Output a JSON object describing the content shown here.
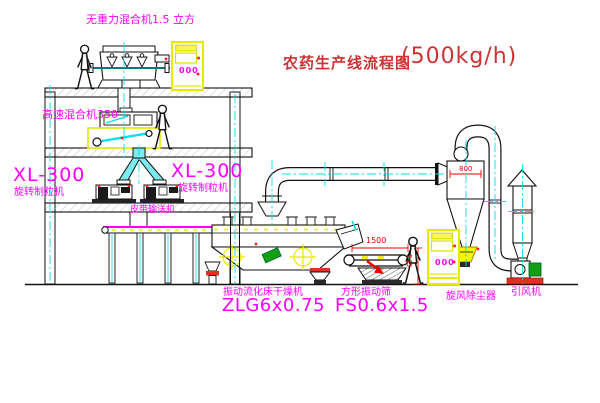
{
  "title": {
    "text": "农药生产线流程图",
    "capacity": "(500kg/h)"
  },
  "labels": {
    "gravity_mixer": "无重力混合机1.5 立方",
    "speed_mixer": "高速混合机350",
    "granulator1_model": "XL-300",
    "granulator1_name": "旋转制粒机",
    "granulator2_model": "XL-300",
    "granulator2_name": "旋转制粒机",
    "belt_conveyor": "皮带输送机",
    "dryer_name": "振动流化床干燥机",
    "dryer_model": "ZLG6x0.75",
    "screen_name": "方形振动筛",
    "screen_model": "FS0.6x1.5",
    "cyclone_name": "旋风除尘器",
    "fan_name": "引风机"
  },
  "dimensions": {
    "screen_length": "1500",
    "screen_height": "545",
    "cyclone_width": "800"
  },
  "cabinets": {
    "display_text": "000"
  },
  "colors": {
    "label_magenta": "#FF00FF",
    "title_red": "#CC3333",
    "dimension_red": "#EE0000",
    "highlight_yellow": "#F0F000",
    "centerline_cyan": "#00E0E8",
    "machine_green": "#12A012",
    "line_black": "#111111"
  }
}
